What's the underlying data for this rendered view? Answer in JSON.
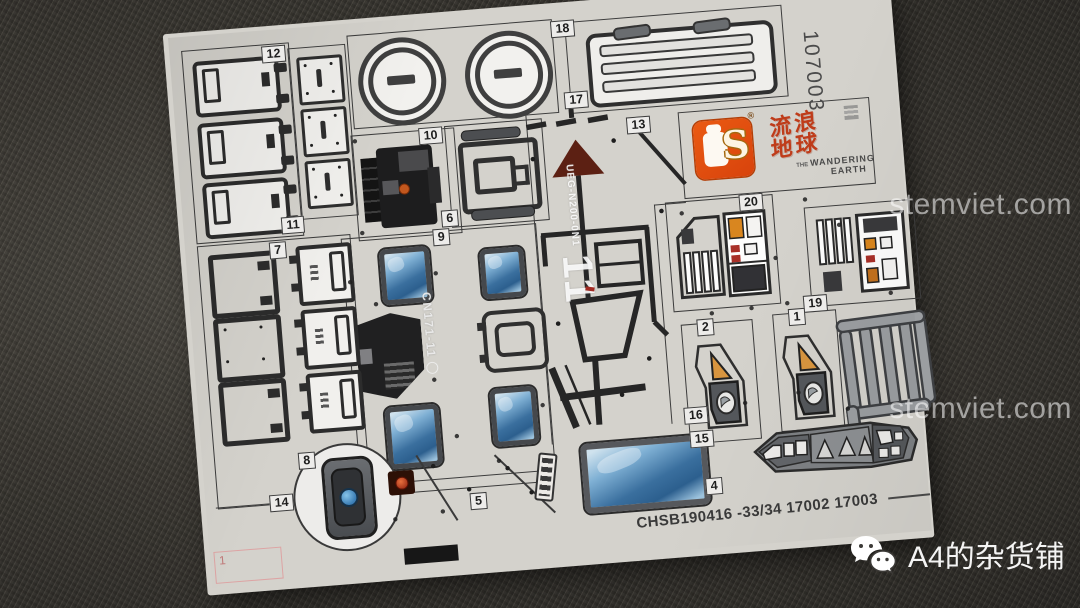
{
  "scene": {
    "watermark_site": "stemviet.com",
    "wechat_channel": "A4的杂货铺"
  },
  "sheet": {
    "part_number": "107003",
    "footer_code": "CHSB190416 -33/34 17002 17003",
    "corner_page_mark": "1",
    "brand_logo": {
      "letter": "S",
      "registered": "®"
    },
    "movie_logo": {
      "cn": "流浪地球",
      "the": "THE",
      "en_line1": "WANDERING",
      "en_line2": "EARTH"
    },
    "markings": {
      "vehicle_code": "CN171-11",
      "big_number": "11",
      "stencil_code": "UEG-N200-0N1"
    },
    "section_labels": {
      "s1": "1",
      "s2": "2",
      "s4": "4",
      "s5": "5",
      "s6": "6",
      "s7": "7",
      "s8": "8",
      "s9": "9",
      "s10": "10",
      "s11": "11",
      "s12": "12",
      "s13": "13",
      "s14": "14",
      "s15": "15",
      "s16": "16",
      "s17": "17",
      "s18": "18",
      "s19": "19",
      "s20": "20"
    }
  }
}
